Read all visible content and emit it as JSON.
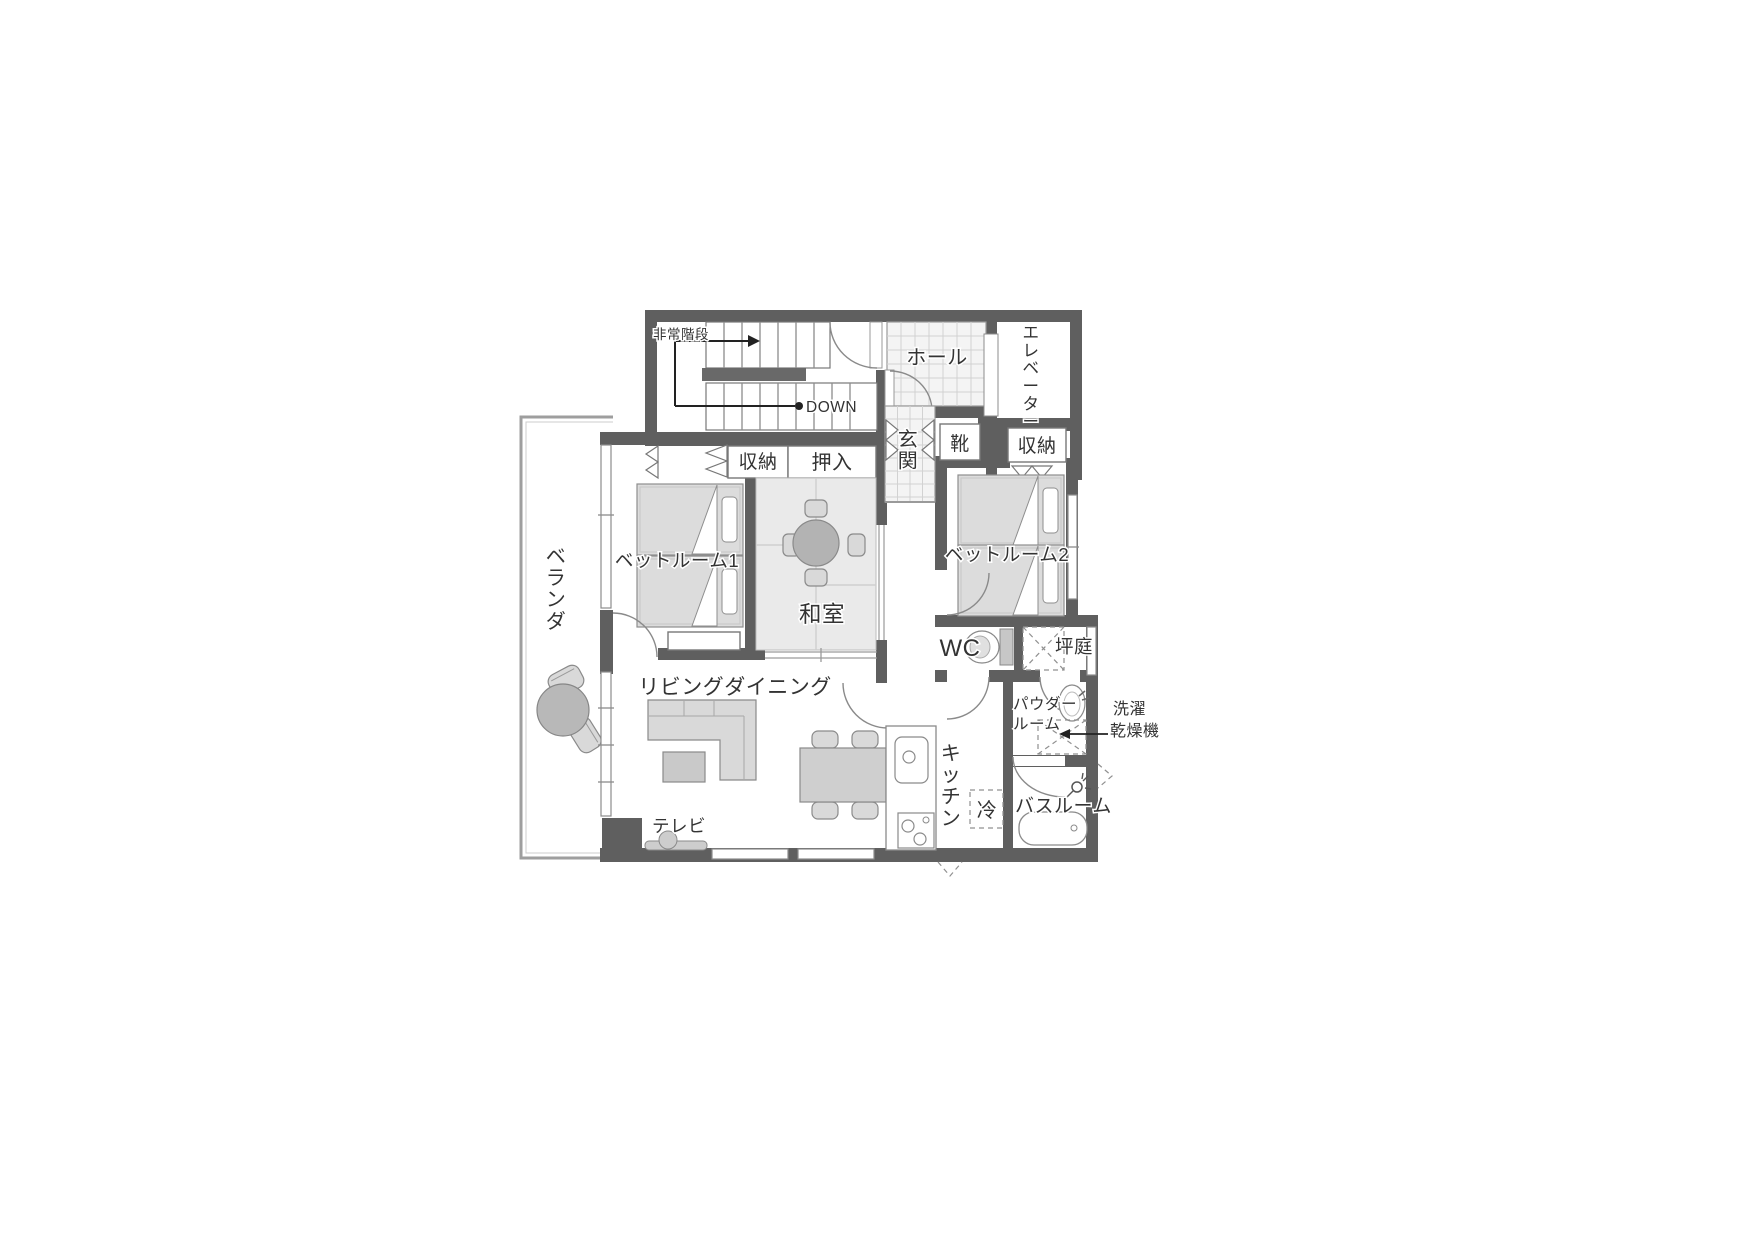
{
  "labels": {
    "emergency_stairs": "非常階段",
    "down": "DOWN",
    "hall": "ホール",
    "elevator": "エレベーター",
    "closet_a": "収納",
    "oshiire": "押入",
    "genkan": "玄関",
    "shoes": "靴",
    "closet_b": "収納",
    "bedroom1": "ベットルーム1",
    "bedroom2": "ベットルーム2",
    "washitsu": "和室",
    "veranda": "ベランダ",
    "living_dining": "リビングダイニング",
    "tv": "テレビ",
    "wc": "WC",
    "tsuboniwa": "坪庭",
    "powder_room_line1": "パウダー",
    "powder_room_line2": "ルーム",
    "laundry_line1": "洗濯",
    "laundry_line2": "乾燥機",
    "kitchen": "キッチン",
    "fridge": "冷",
    "bathroom": "バスルーム"
  },
  "colors": {
    "wall": "#5f5f5f",
    "tatami": "#eaeaea",
    "furniture": "#d9d9d9",
    "text": "#333333",
    "background": "#ffffff"
  }
}
